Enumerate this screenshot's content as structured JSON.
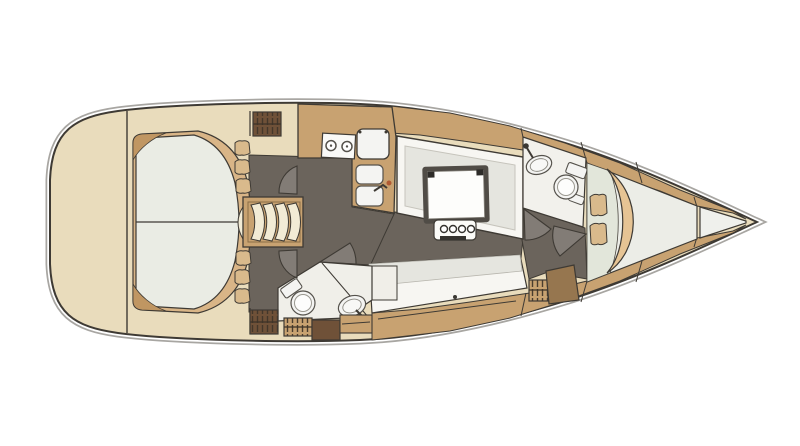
{
  "canvas": {
    "width": 800,
    "height": 446,
    "background_color": "#ffffff"
  },
  "diagram": {
    "type": "sailboat-interior-floorplan",
    "orientation": "bow-right",
    "colors": {
      "page": "#ffffff",
      "outline": "#3e3a34",
      "outline_soft": "#a8a6a2",
      "deck_beige": "#e9dcbc",
      "wood_tan": "#c8a271",
      "wood_tan_dark": "#c09662",
      "floor_dark": "#6b645c",
      "mattress": "#eaece4",
      "mattress_shaded": "#e2e6da",
      "mattress_light": "#ecede7",
      "blanket": "#d9b587",
      "blanket_fwd": "#e6c494",
      "pillow": "#d9ba8c",
      "trim_white": "#f7f6f2",
      "seat_gray": "#e5e5df",
      "steps_cream": "#f2ebd5",
      "locker_brown_dark": "#6f5138",
      "locker_brown": "#96764f",
      "hatch_stroke": "#3c3227",
      "table_frame": "#504c46",
      "fixture_white": "#f4f4f2",
      "fixture_line": "#55524c",
      "faucet_accent": "#b05a33",
      "bow_locker": "#eff0ec"
    },
    "compartments": [
      {
        "name": "aft-double-berth"
      },
      {
        "name": "companionway-steps"
      },
      {
        "name": "galley"
      },
      {
        "name": "saloon"
      },
      {
        "name": "aft-head"
      },
      {
        "name": "side-settee"
      },
      {
        "name": "forward-head"
      },
      {
        "name": "forward-v-berth"
      },
      {
        "name": "bow-locker"
      }
    ],
    "fixtures": [
      {
        "name": "stove-two-burner"
      },
      {
        "name": "icebox"
      },
      {
        "name": "double-sink"
      },
      {
        "name": "galley-faucet"
      },
      {
        "name": "saloon-table"
      },
      {
        "name": "bottle-holder"
      },
      {
        "name": "aft-toilet"
      },
      {
        "name": "aft-washbasin"
      },
      {
        "name": "forward-toilet"
      },
      {
        "name": "forward-washbasin"
      },
      {
        "name": "louvered-lockers"
      },
      {
        "name": "door-swing-arcs"
      }
    ]
  }
}
